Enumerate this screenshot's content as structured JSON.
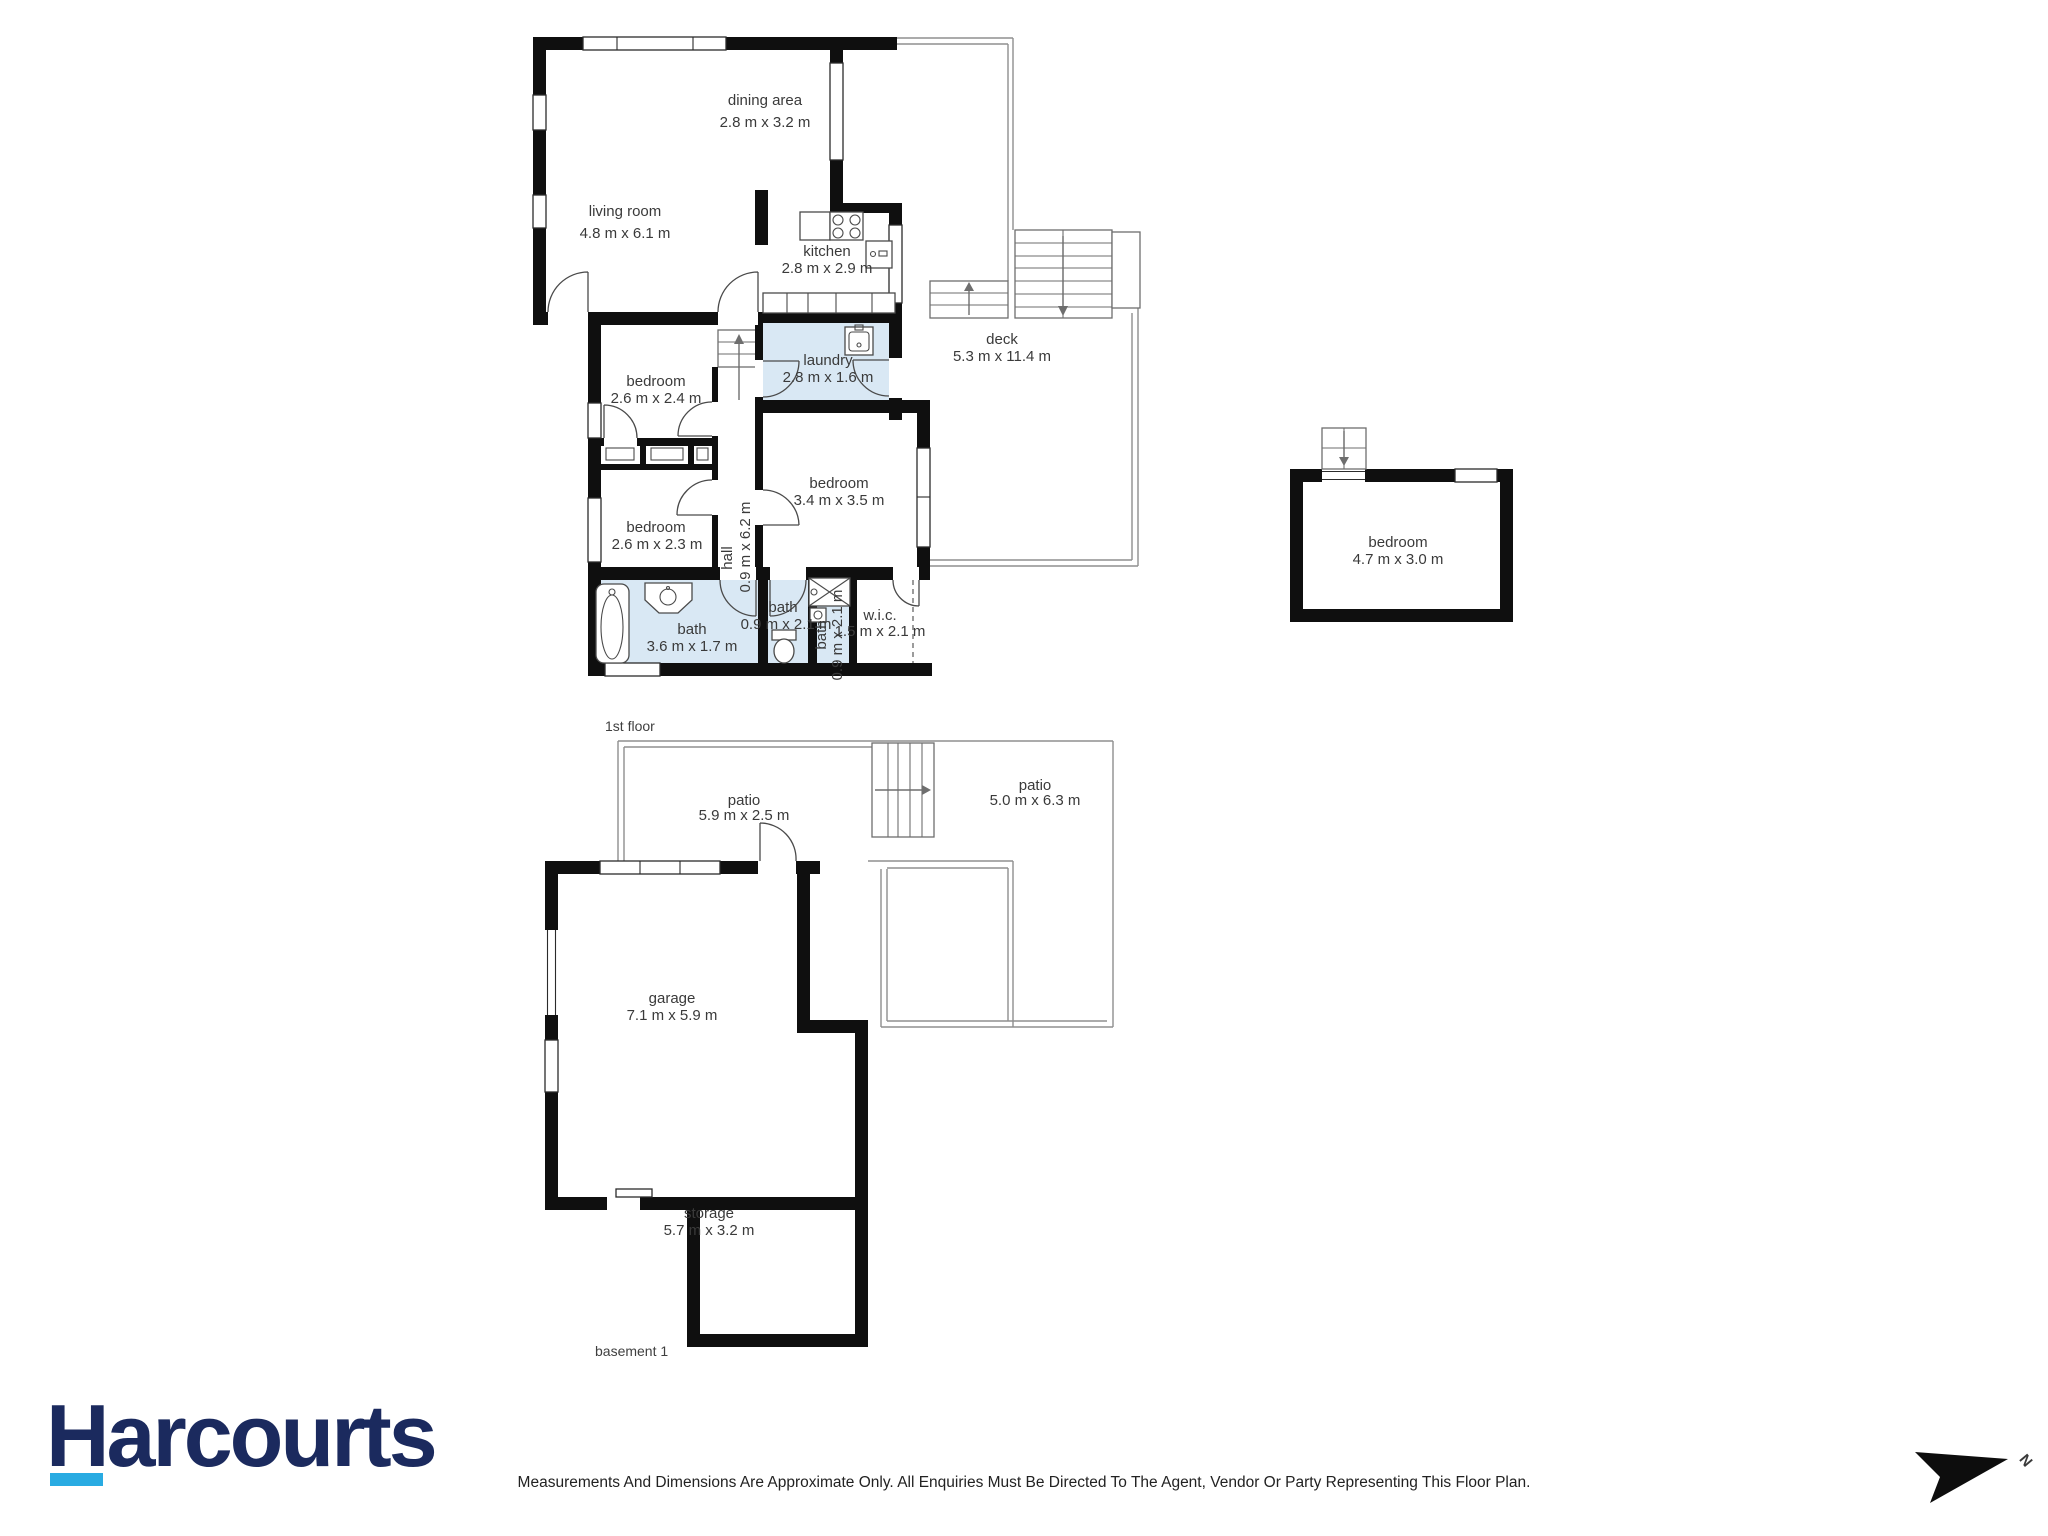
{
  "floors": {
    "f1": {
      "label": "1st floor",
      "rooms": {
        "dining": {
          "name": "dining area",
          "dims": "2.8 m x 3.2 m"
        },
        "living": {
          "name": "living room",
          "dims": "4.8 m x 6.1 m"
        },
        "kitchen": {
          "name": "kitchen",
          "dims": "2.8 m x 2.9 m"
        },
        "laundry": {
          "name": "laundry",
          "dims": "2.8 m x 1.6 m"
        },
        "deck": {
          "name": "deck",
          "dims": "5.3 m x 11.4 m"
        },
        "bed1": {
          "name": "bedroom",
          "dims": "2.6 m x 2.4 m"
        },
        "bed2": {
          "name": "bedroom",
          "dims": "2.6 m x 2.3 m"
        },
        "bed3": {
          "name": "bedroom",
          "dims": "3.4 m x 3.5 m"
        },
        "bed4": {
          "name": "bedroom",
          "dims": "4.7 m x 3.0 m"
        },
        "hall": {
          "name": "hall",
          "dims": "0.9 m x 6.2 m"
        },
        "bath1": {
          "name": "bath",
          "dims": "3.6 m x 1.7 m"
        },
        "bath2": {
          "name": "bath",
          "dims": "0.9 m x 2.1 m"
        },
        "bath3": {
          "name": "bath",
          "dims": "0.9 m x 2.1 m"
        },
        "wic": {
          "name": "w.i.c.",
          "dims": "1.5 m x 2.1 m"
        }
      }
    },
    "b1": {
      "label": "basement 1",
      "rooms": {
        "patio1": {
          "name": "patio",
          "dims": "5.9 m x 2.5 m"
        },
        "patio2": {
          "name": "patio",
          "dims": "5.0 m x 6.3 m"
        },
        "garage": {
          "name": "garage",
          "dims": "7.1 m x 5.9 m"
        },
        "storage": {
          "name": "storage",
          "dims": "5.7 m x 3.2 m"
        }
      }
    }
  },
  "branding": {
    "logo_text": "Harcourts"
  },
  "footer": {
    "disclaimer": "Measurements And Dimensions Are Approximate Only. All Enquiries Must Be Directed To The Agent, Vendor Or Party Representing This Floor Plan."
  },
  "compass": {
    "label": "N"
  },
  "palette": {
    "wall": "#0f0f0f",
    "wet_room_fill": "#d9e8f4",
    "logo_navy": "#1b2a5e",
    "logo_cyan": "#29abe2",
    "outline_gray": "#8f8f8f",
    "label_text": "#3a3a3a"
  }
}
